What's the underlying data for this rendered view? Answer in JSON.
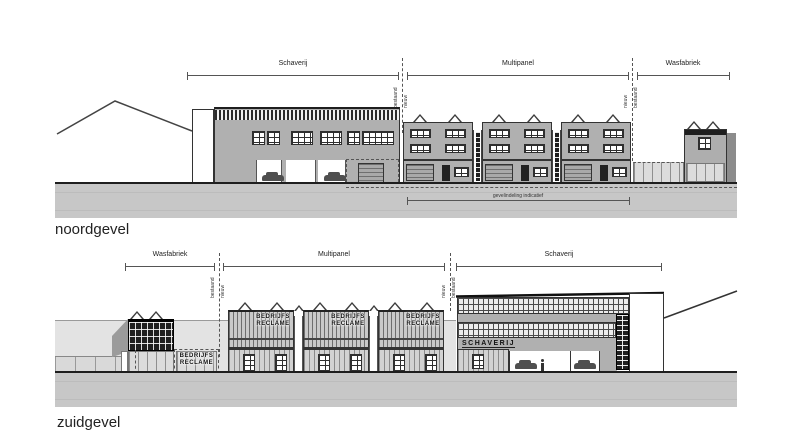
{
  "north": {
    "title": "noordgevel",
    "dim_schaverij": "Schaverij",
    "dim_multipanel": "Multipanel",
    "dim_wasfabriek": "Wasfabriek",
    "boundary_left": {
      "left_label": "bestaand",
      "right_label": "nieuw"
    },
    "boundary_right": {
      "left_label": "nieuw",
      "right_label": "bestaand"
    },
    "note": "gevelindeling indicatief"
  },
  "south": {
    "title": "zuidgevel",
    "dim_wasfabriek": "Wasfabriek",
    "dim_multipanel": "Multipanel",
    "dim_schaverij": "Schaverij",
    "boundary_left": {
      "left_label": "bestaand",
      "right_label": "nieuw"
    },
    "boundary_right": {
      "left_label": "nieuw",
      "right_label": "bestaand"
    },
    "sign_line1": "BEDRIJFS",
    "sign_line2": "RECLAME",
    "schaverij_sign": "SCHAVERIJ"
  },
  "colors": {
    "line": "#3a3a3a",
    "facade_gray": "#b0b0b0",
    "dark_band": "#1f1f1f",
    "ground": "#c7c7c7",
    "backdrop": "#e3e3e3",
    "glazing": "#dcdcdc"
  }
}
